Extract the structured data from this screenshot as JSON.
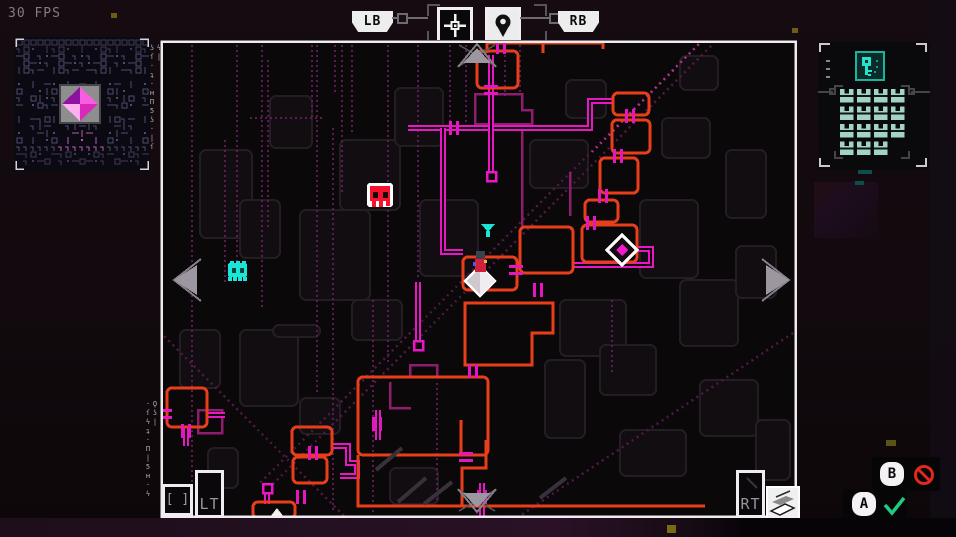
{
  "hud": {
    "fps_label": "30 FPS",
    "shoulder_left": "LB",
    "shoulder_right": "RB",
    "trigger_left": "LT",
    "trigger_right": "RT",
    "bracket_icon_label": "[ ]",
    "tabs": [
      {
        "id": "target",
        "icon": "crosshair-icon",
        "selected": false
      },
      {
        "id": "location",
        "icon": "map-pin-icon",
        "selected": true
      }
    ],
    "prompts": [
      {
        "button": "B",
        "action": "deny",
        "icon": "no-entry-icon",
        "color": "#e2281c"
      },
      {
        "button": "A",
        "action": "confirm",
        "icon": "check-icon",
        "color": "#1fcb80"
      }
    ]
  },
  "decor": {
    "glyphs_top": "ϟ|ʖſ·ʇ·ʜΠ5ʖ·|ſ",
    "glyphs_bottom": "Ϙʖ|·ſϟʇ·Π|5ʜ·ϟ"
  },
  "inventory": {
    "slots": 15,
    "slot_icon": "crate-icon",
    "header_icon": "key-icon"
  },
  "map": {
    "colors": {
      "bg": "#0b080a",
      "frame": "#efebef",
      "room": "#e83e1a",
      "track": "#ea16c6",
      "door": "#e316c0",
      "dim": "#8e1d6e",
      "trace": "#5c1b56",
      "diag": "#4f1849",
      "diag_bright": "#aa2f90",
      "silhouette": "#241e24",
      "streak": "#38303a",
      "arrow": "#9c96a0",
      "arrow_line": "#847e88",
      "cyan": "#19e6d6",
      "skull_red": "#f5132d",
      "white": "#f2eef2"
    },
    "rooms": [
      [
        477,
        51,
        41,
        37
      ],
      [
        613,
        93,
        36,
        22
      ],
      [
        612,
        120,
        38,
        33
      ],
      [
        600,
        158,
        38,
        35
      ],
      [
        585,
        200,
        33,
        22
      ],
      [
        582,
        225,
        55,
        37
      ],
      [
        463,
        257,
        54,
        33
      ],
      [
        520,
        227,
        53,
        46
      ],
      [
        358,
        377,
        130,
        78
      ],
      [
        292,
        427,
        40,
        28
      ],
      [
        293,
        457,
        34,
        26
      ],
      [
        253,
        502,
        42,
        16
      ],
      [
        167,
        388,
        40,
        39
      ]
    ],
    "room_paths": [
      "M465,303 H553 V333 H532 V365 H465 Z",
      "M487,43 V53",
      "M487,43 H543",
      "M543,43 V53",
      "M543,43 H603 V49",
      "M358,455 V506 H705",
      "M486,440 V468 H462 V506",
      "M461,420 V455"
    ],
    "doors": [
      {
        "x": 501,
        "y": 47,
        "o": "v"
      },
      {
        "x": 491,
        "y": 90,
        "o": "h"
      },
      {
        "x": 630,
        "y": 116,
        "o": "v"
      },
      {
        "x": 618,
        "y": 156,
        "o": "v"
      },
      {
        "x": 603,
        "y": 196,
        "o": "v"
      },
      {
        "x": 591,
        "y": 223,
        "o": "v"
      },
      {
        "x": 516,
        "y": 270,
        "o": "h"
      },
      {
        "x": 538,
        "y": 290,
        "o": "v"
      },
      {
        "x": 473,
        "y": 371,
        "o": "v"
      },
      {
        "x": 454,
        "y": 128,
        "o": "v"
      },
      {
        "x": 313,
        "y": 453,
        "o": "v"
      },
      {
        "x": 186,
        "y": 431,
        "o": "v"
      },
      {
        "x": 301,
        "y": 497,
        "o": "v"
      },
      {
        "x": 466,
        "y": 457,
        "o": "h"
      },
      {
        "x": 482,
        "y": 497,
        "o": "v"
      },
      {
        "x": 165,
        "y": 414,
        "o": "h"
      },
      {
        "x": 377,
        "y": 424,
        "o": "v"
      }
    ],
    "tracks": [
      "M408,128 H590 V101 H613",
      "M491,55 V178",
      "M443,128 V252 H463",
      "M573,265 H651 V249 H638",
      "M418,282 V345",
      "M332,446 H348 V463 H357 V476 H340",
      "M267,493 V504",
      "M482,483 V517",
      "M207,415 H225",
      "M378,410 V440",
      "M186,426 V446"
    ],
    "end_squares": [
      [
        487,
        172
      ],
      [
        414,
        341
      ],
      [
        263,
        484
      ]
    ],
    "dim_paths": [
      "M475,94 H522 V110 H532 V124 H475 Z",
      "M198,410 H222 V433 H198 Z",
      "M410,365 H437 V377 H410 Z",
      "M570,172 V216",
      "M522,124 V227",
      "M390,382 V408 H411"
    ],
    "traces": [
      "192,45 192,512",
      "225,140 225,282",
      "237,45 237,270",
      "262,45 262,310",
      "268,60 268,230",
      "312,45 312,118",
      "250,118 323,118",
      "317,45 317,392",
      "333,128 333,512",
      "335,45 335,92",
      "342,45 342,195",
      "352,45 352,132",
      "373,300 373,512",
      "388,45 388,362",
      "418,45 418,280",
      "450,45 450,122",
      "466,45 466,122",
      "505,45 505,96",
      "520,45 520,92",
      "437,383 437,503",
      "612,300 612,375"
    ],
    "diagonals": [
      {
        "pts": "703,40 258,485",
        "bright": false
      },
      {
        "pts": "711,46 266,491",
        "bright": false
      },
      {
        "pts": "703,40 592,152",
        "bright": true
      },
      {
        "pts": "793,333 518,517",
        "bright": false
      },
      {
        "pts": "160,332 345,517",
        "bright": false
      }
    ],
    "silhouettes": [
      [
        200,
        150,
        52,
        88
      ],
      [
        270,
        96,
        42,
        52
      ],
      [
        300,
        210,
        70,
        90
      ],
      [
        340,
        140,
        60,
        70
      ],
      [
        395,
        88,
        48,
        58
      ],
      [
        420,
        200,
        58,
        76
      ],
      [
        352,
        300,
        50,
        40
      ],
      [
        180,
        330,
        40,
        58
      ],
      [
        240,
        330,
        58,
        76
      ],
      [
        273,
        325,
        47,
        12
      ],
      [
        530,
        140,
        58,
        48
      ],
      [
        560,
        300,
        66,
        56
      ],
      [
        600,
        345,
        56,
        50
      ],
      [
        640,
        200,
        58,
        78
      ],
      [
        662,
        118,
        48,
        40
      ],
      [
        680,
        280,
        58,
        66
      ],
      [
        700,
        380,
        58,
        56
      ],
      [
        620,
        430,
        66,
        46
      ],
      [
        545,
        360,
        40,
        78
      ],
      [
        390,
        468,
        48,
        36
      ],
      [
        300,
        398,
        40,
        36
      ],
      [
        240,
        200,
        40,
        58
      ],
      [
        726,
        150,
        40,
        68
      ],
      [
        756,
        420,
        34,
        60
      ],
      [
        566,
        80,
        40,
        38
      ],
      [
        680,
        56,
        38,
        34
      ],
      [
        736,
        246,
        40,
        52
      ],
      [
        208,
        448,
        30,
        40
      ]
    ],
    "streaks": [
      "M398,502 L426,478",
      "M424,504 L452,482",
      "M376,470 L402,448",
      "M540,498 L566,478"
    ],
    "markers": [
      {
        "type": "skull",
        "x": 380,
        "y": 197
      },
      {
        "type": "creature",
        "x": 238,
        "y": 272
      },
      {
        "type": "beacon",
        "x": 488,
        "y": 229
      },
      {
        "type": "player",
        "x": 480,
        "y": 281
      },
      {
        "type": "objective",
        "x": 622,
        "y": 250
      },
      {
        "type": "arrow-up-white",
        "x": 277,
        "y": 512
      }
    ],
    "nav_arrows": [
      {
        "dir": "up",
        "x": 477,
        "y": 55
      },
      {
        "dir": "down",
        "x": 477,
        "y": 501
      },
      {
        "dir": "left",
        "x": 185,
        "y": 280
      },
      {
        "dir": "right",
        "x": 778,
        "y": 280
      }
    ]
  }
}
